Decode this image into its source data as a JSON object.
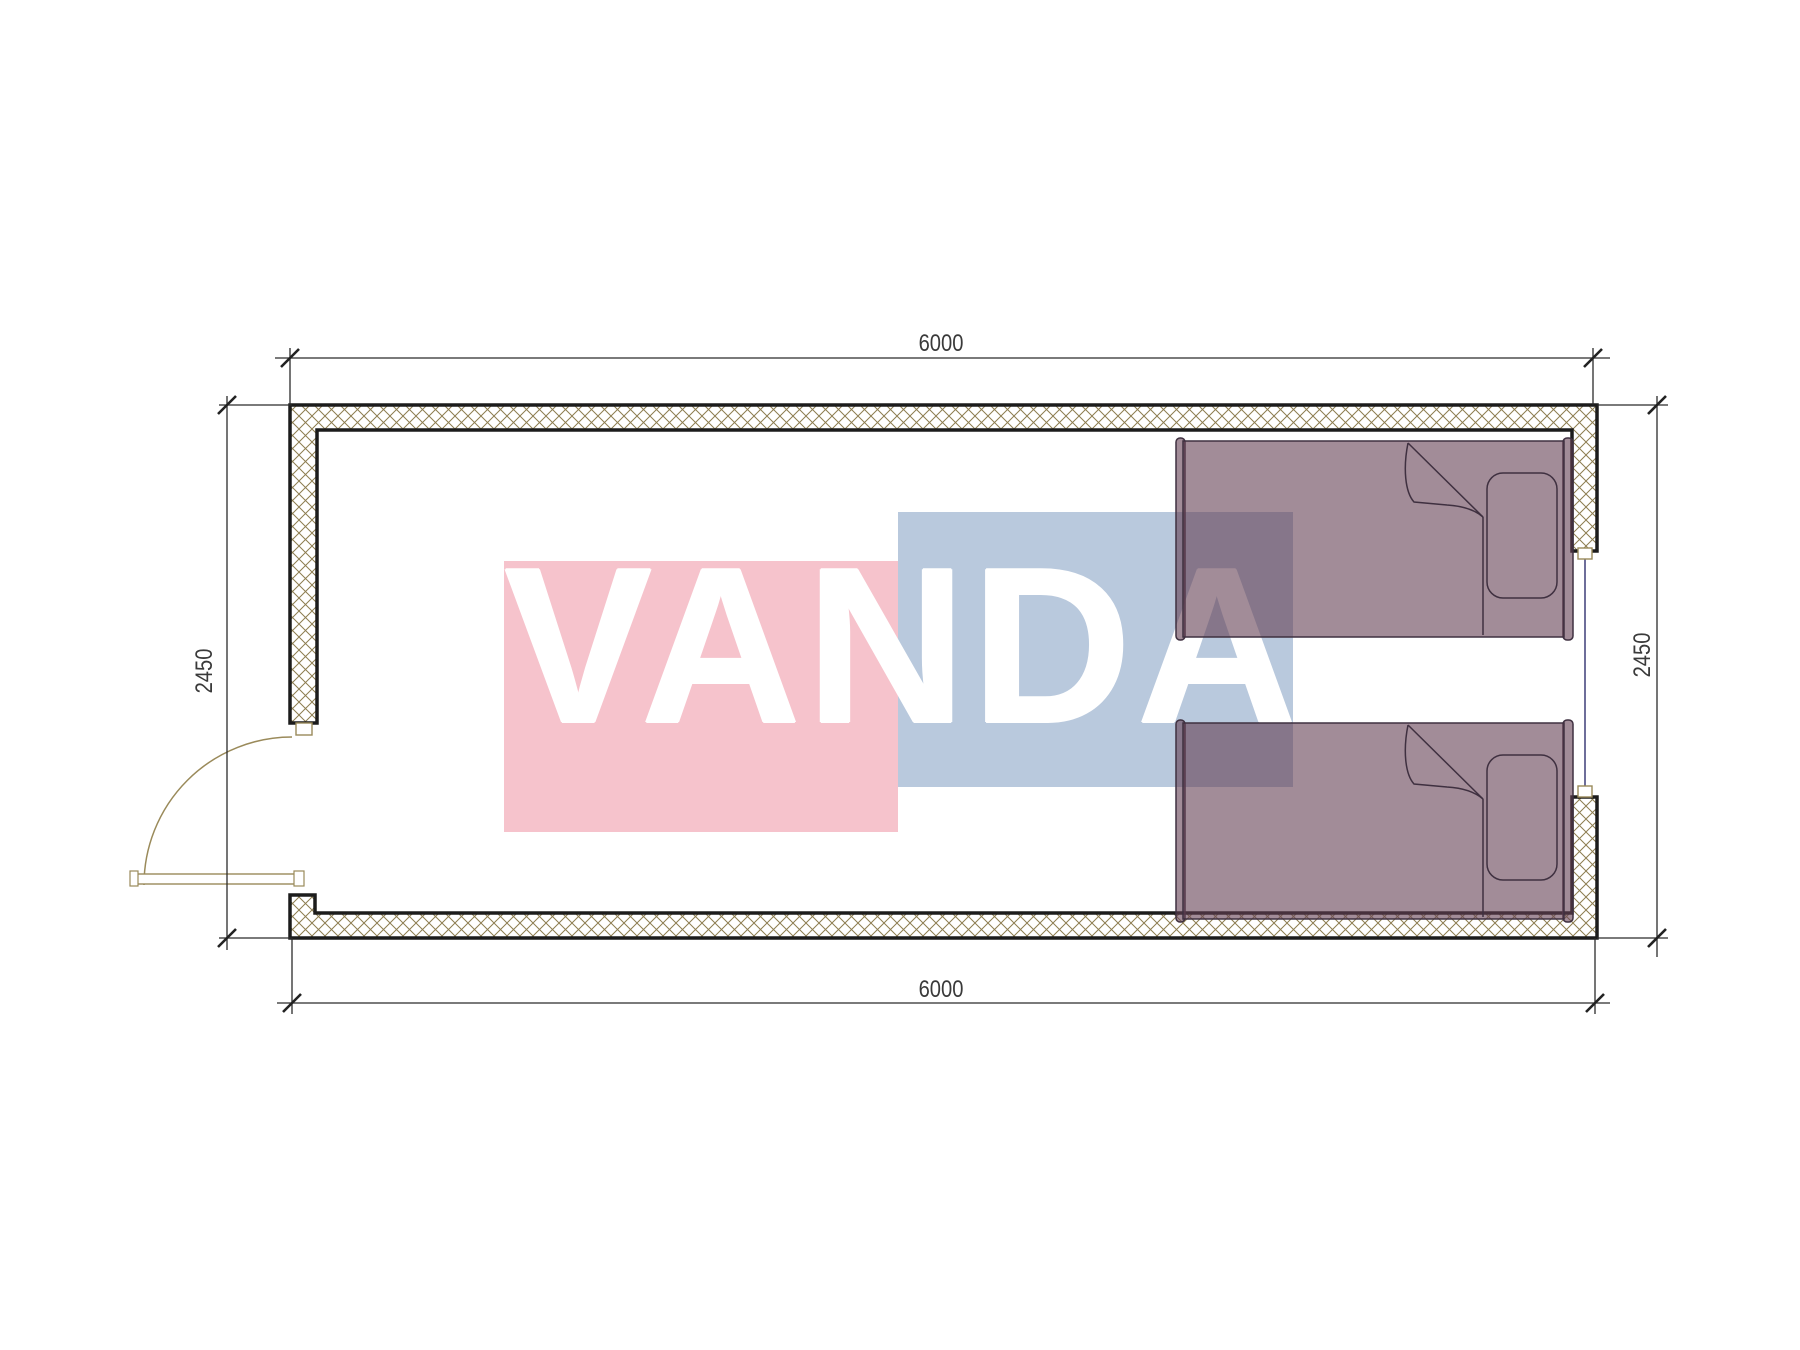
{
  "plan": {
    "dimensions": {
      "top": "6000",
      "bottom": "6000",
      "left": "2450",
      "right": "2450"
    },
    "watermark": {
      "text": "VANDA",
      "pink_color": "#f6c3cc",
      "blue_color": "#b9c9dd",
      "text_color": "#ffffff"
    },
    "palette": {
      "background": "#ffffff",
      "wall_line": "#1c1c1c",
      "hatch_line": "#8d7d50",
      "dimension_line": "#2b2b2b",
      "door_line": "#9a8a5a",
      "window_line": "#4a4a80",
      "bed_fill": "rgba(100,63,83,0.6)",
      "bed_outline": "#3f3040"
    }
  }
}
